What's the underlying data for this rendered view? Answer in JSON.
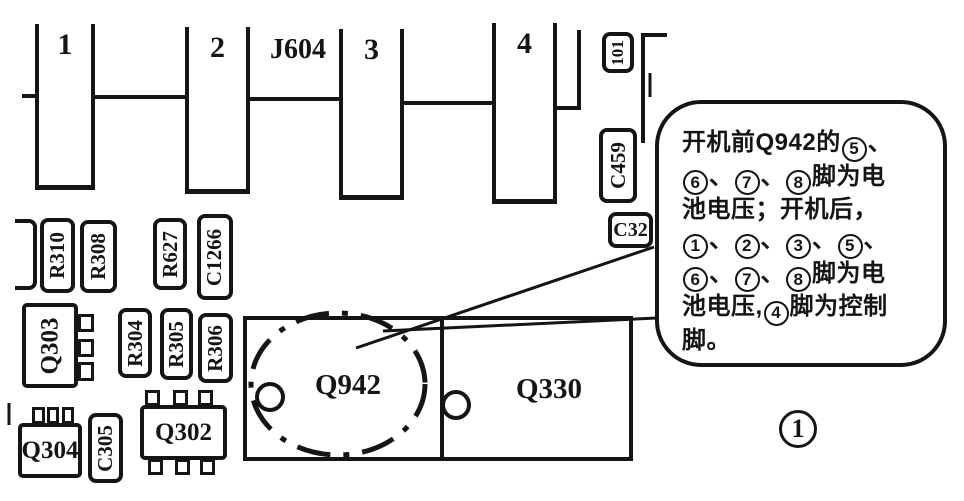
{
  "figure_label": "1",
  "connector": {
    "name": "J604",
    "tabs": [
      {
        "label": "1"
      },
      {
        "label": "2"
      },
      {
        "label": "3"
      },
      {
        "label": "4"
      }
    ]
  },
  "components": {
    "r310": "R310",
    "r308": "R308",
    "r627": "R627",
    "c1266": "C1266",
    "q303": "Q303",
    "r304": "R304",
    "r305": "R305",
    "r306": "R306",
    "q304": "Q304",
    "c305": "C305",
    "q302": "Q302",
    "q942": "Q942",
    "q330": "Q330",
    "l101": "101",
    "c459": "C459",
    "c32": "C32"
  },
  "callout": {
    "lines": [
      "开机前Q942的⑤、",
      "⑥、⑦、⑧脚为电",
      "池电压；开机后，",
      "①、②、③、⑤、",
      "⑥、⑦、⑧脚为电",
      "池电压,④脚为控制",
      "脚。"
    ]
  },
  "colors": {
    "ink": "#151515",
    "paper": "#ffffff"
  }
}
